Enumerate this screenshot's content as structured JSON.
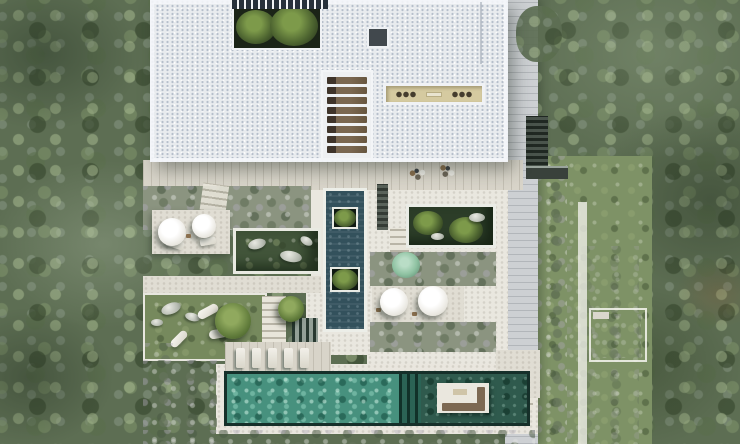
{
  "scene": {
    "description": "Top-down aerial 3D render of a modern white flat-roof villa: roof courtyard with trees, pergola strip, wooden louver panel, sunken patio, reflecting pool with tree planters, sunken garden courts, parasol terraces, long teal lap pool with island sofa platform, lounger deck, stone paths, lawns and dense surrounding woodland"
  },
  "palette": {
    "forest_base": "#5d6e53",
    "lawn_right": "#7e9266",
    "lawn_garden": "#76895d",
    "lawn_dark": "#42553a",
    "shrub": "#8b9480",
    "roof": "#e8ebee",
    "deck": "#d8d4c9",
    "walkway": "#cdd0d3",
    "stone": "#e0ddd3",
    "stone_bright": "#e9e7df",
    "pool_surround": "#e9e6de",
    "reflect_pool": "#33515c",
    "pool_bright": "#47917e",
    "pool_grate": "#2b6355",
    "pool_dark": "#2f5a4d",
    "island": "#eae7de",
    "sofa": "#7c6852",
    "clerestory": "#d5caa0",
    "skylight": "#41484d",
    "courtyard_dark": "#1b2417",
    "sunken_court": "#2c3d28",
    "path_light": "#efefe8",
    "stairs_dark": "#39413b"
  },
  "counts": {
    "louver_slats": 8,
    "pool_loungers": 5
  }
}
